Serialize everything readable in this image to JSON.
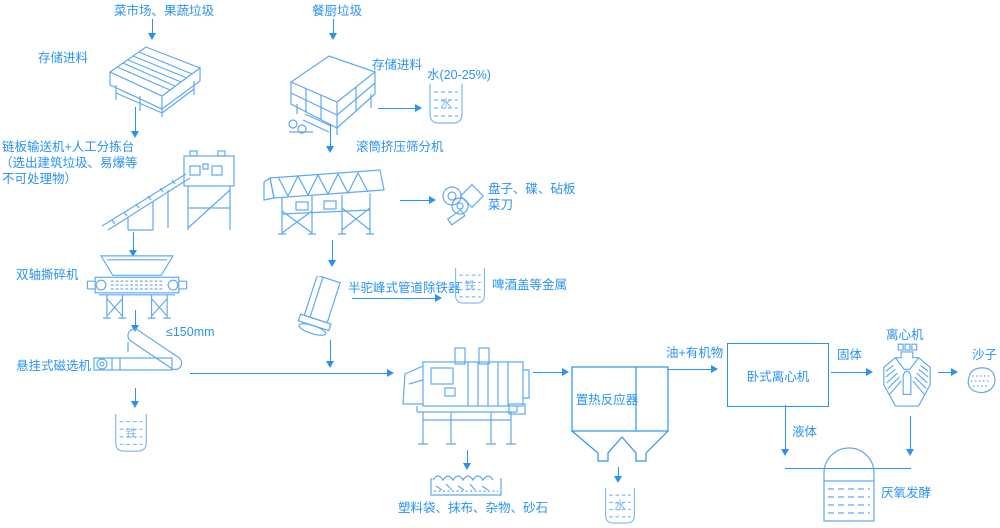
{
  "colors": {
    "arrow_text_blue": "#2a93f2",
    "machine_line_blue": "#5ea9f2",
    "light_detail_blue": "#79b7f5",
    "background": "#ffffff"
  },
  "labels": {
    "source_vegetable": "菜市场、果蔬垃圾",
    "storage_feed_1": "存储进料",
    "chain_conveyor_line1": "链板输送机+人工分拣台",
    "chain_conveyor_line2": "（选出建筑垃圾、易爆等",
    "chain_conveyor_line3": "不可处理物）",
    "double_shaft_shredder": "双轴撕碎机",
    "size_limit": "≤150mm",
    "suspended_magnetic_separator": "悬挂式磁选机",
    "iron_beaker_left": "铁",
    "source_kitchen": "餐厨垃圾",
    "storage_feed_2": "存储进料",
    "water_percent": "水(20-25%)",
    "water_beaker_top": "水",
    "drum_press_screen": "滚筒挤压筛分机",
    "plates_line1": "盘子、碟、砧板",
    "plates_line2": "菜刀",
    "hump_pipe_deironer": "半驼峰式管道除铁器",
    "iron_beaker_mid": "铁",
    "beer_caps_metal": "啤酒盖等金属",
    "heat_reactor": "置热反应器",
    "oil_organics": "油+有机物",
    "horizontal_centrifuge": "卧式离心机",
    "solid": "固体",
    "centrifuge": "离心机",
    "sand": "沙子",
    "liquid": "液体",
    "anaerobic_fermentation": "厌氧发酵",
    "residue": "塑料袋、抹布、杂物、砂石",
    "water_beaker_bottom": "水"
  }
}
